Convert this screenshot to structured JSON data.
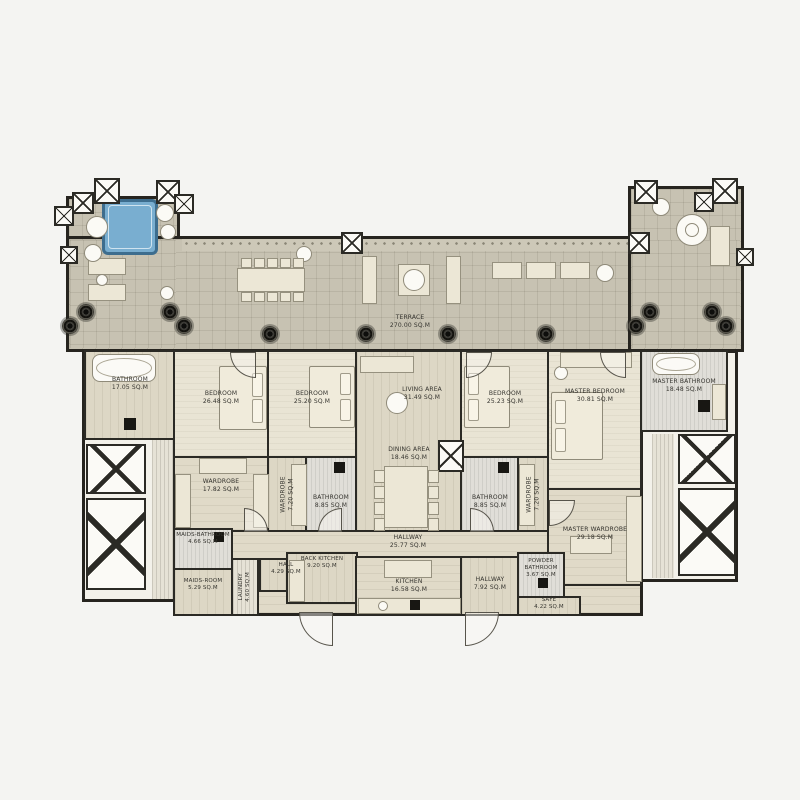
{
  "title": "Apartment Floor Plan",
  "colors": {
    "background": "#f4f4f2",
    "wall": "#26241f",
    "terrace_tile": "#c7c2b2",
    "wood_floor": "#ded7c4",
    "carpet": "#e8e3d3",
    "marble": "#dedcd6",
    "jacuzzi_blue": "#74a9cc"
  },
  "icons": {
    "column_marker": "crossed-box",
    "ceiling_speaker": "dark-circle",
    "jacuzzi": "blue-square",
    "door_swing": "quarter-arc",
    "planter": "white-circle",
    "elevator_shaft": "crossed-box"
  },
  "plan": {
    "rooms": [
      {
        "id": "terrace",
        "name": "TERRACE",
        "area": "270.00 SQ.M"
      },
      {
        "id": "bathroom-1",
        "name": "BATHROOM",
        "area": "17.05 SQ.M"
      },
      {
        "id": "bedroom-1",
        "name": "BEDROOM",
        "area": "26.48 SQ.M"
      },
      {
        "id": "bedroom-2",
        "name": "BEDROOM",
        "area": "25.20 SQ.M"
      },
      {
        "id": "living-area",
        "name": "LIVING AREA",
        "area": "31.49 SQ.M"
      },
      {
        "id": "dining-area",
        "name": "DINING AREA",
        "area": "18.46 SQ.M"
      },
      {
        "id": "bedroom-3",
        "name": "BEDROOM",
        "area": "25.23 SQ.M"
      },
      {
        "id": "master-bedroom",
        "name": "MASTER BEDROOM",
        "area": "30.81 SQ.M"
      },
      {
        "id": "master-bathroom",
        "name": "MASTER BATHROOM",
        "area": "18.48 SQ.M"
      },
      {
        "id": "wardrobe-1",
        "name": "WARDROBE",
        "area": "17.82 SQ.M"
      },
      {
        "id": "wardrobe-2",
        "name": "WARDROBE",
        "area": "7.20 SQ.M"
      },
      {
        "id": "bathroom-2",
        "name": "BATHROOM",
        "area": "8.85 SQ.M"
      },
      {
        "id": "bathroom-3",
        "name": "BATHROOM",
        "area": "8.85 SQ.M"
      },
      {
        "id": "wardrobe-3",
        "name": "WARDROBE",
        "area": "7.20 SQ.M"
      },
      {
        "id": "master-wardrobe",
        "name": "MASTER WARDROBE",
        "area": "29.18 SQ.M"
      },
      {
        "id": "hallway-main",
        "name": "HALLWAY",
        "area": "25.77 SQ.M"
      },
      {
        "id": "maids-bathroom",
        "name": "MAIDS-BATHROOM",
        "area": "4.66 SQ.M"
      },
      {
        "id": "maids-room",
        "name": "MAIDS-ROOM",
        "area": "5.29 SQ.M"
      },
      {
        "id": "laundry",
        "name": "LAUNDRY",
        "area": "4.60 SQ.M"
      },
      {
        "id": "hall",
        "name": "HALL",
        "area": "4.29 SQ.M"
      },
      {
        "id": "back-kitchen",
        "name": "BACK KITCHEN",
        "area": "9.20 SQ.M"
      },
      {
        "id": "kitchen",
        "name": "KITCHEN",
        "area": "16.58 SQ.M"
      },
      {
        "id": "hallway-2",
        "name": "HALLWAY",
        "area": "7.92 SQ.M"
      },
      {
        "id": "powder-bathroom",
        "name": "POWDER BATHROOM",
        "area": "3.67 SQ.M"
      },
      {
        "id": "safe",
        "name": "SAFE",
        "area": "4.22 SQ.M"
      }
    ]
  }
}
